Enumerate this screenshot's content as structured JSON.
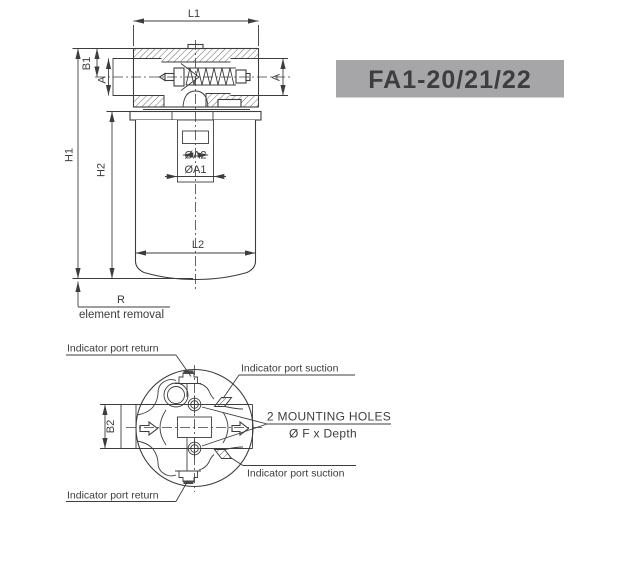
{
  "banner": {
    "text": "FA1-20/21/22",
    "bg": "#a6a6a8",
    "fg": "#ffffff"
  },
  "side_view": {
    "dim_labels": {
      "l1": "L1",
      "b1": "B1",
      "a_left": "A",
      "a_right": "A",
      "h1": "H1",
      "h2": "H2",
      "da2": "ØA2",
      "da1": "ØA1",
      "l2": "L2",
      "r": "R"
    },
    "notes": {
      "element_removal": "element removal"
    }
  },
  "bottom_view": {
    "dim_labels": {
      "b2": "B2"
    },
    "annotations": {
      "return_top": "Indicator port return",
      "suction_top": "Indicator port suction",
      "mounting_line1": "2 MOUNTING HOLES",
      "mounting_line2": "Ø F x Depth",
      "suction_bottom": "Indicator port suction",
      "return_bottom": "Indicator port return"
    }
  },
  "colors": {
    "line": "#3d3d40",
    "text": "#3d3d40"
  }
}
